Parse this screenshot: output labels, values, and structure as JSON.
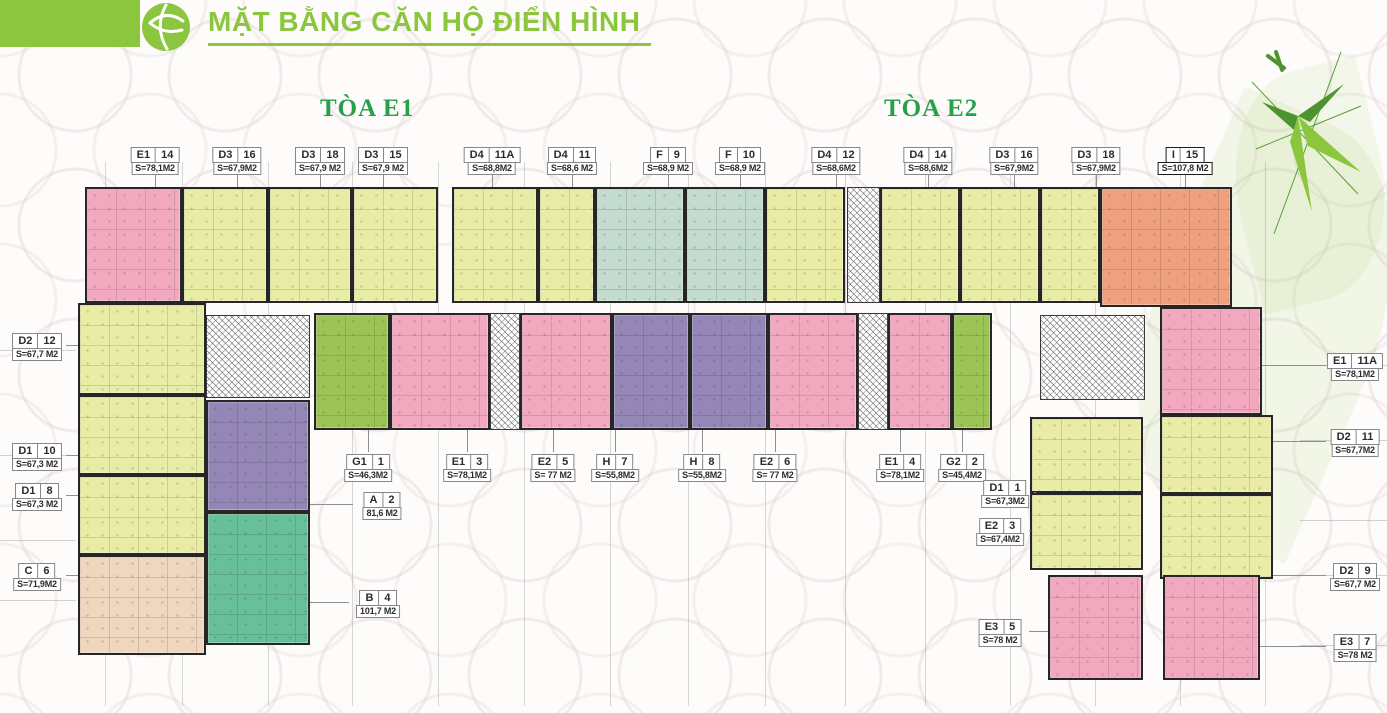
{
  "header": {
    "title": "MẶT BẰNG CĂN HỘ ĐIỂN HÌNH"
  },
  "towers": [
    {
      "label": "TÒA E1"
    },
    {
      "label": "TÒA E2"
    }
  ],
  "palette": {
    "accent_green": "#8CC63F",
    "tower_green": "#27A04A",
    "wall": "#262626",
    "pink": "#F2A9BF",
    "yellow": "#E9ECA4",
    "teal": "#C3DCCF",
    "purple": "#9486B6",
    "green": "#9CC455",
    "jade": "#68C09A",
    "peach": "#EFD6BD",
    "orange": "#EFA07E"
  },
  "plan": {
    "units": [
      {
        "code": "E1",
        "no": "14",
        "area": "S=78,1M2",
        "color": "pink",
        "block": [
          85,
          187,
          97,
          116
        ],
        "label": [
          155,
          145
        ],
        "leader": "down"
      },
      {
        "code": "D3",
        "no": "16",
        "area": "S=67,9M2",
        "color": "yellow",
        "block": [
          182,
          187,
          86,
          116
        ],
        "label": [
          237,
          145
        ],
        "leader": "down"
      },
      {
        "code": "D3",
        "no": "18",
        "area": "S=67,9 M2",
        "color": "yellow",
        "block": [
          268,
          187,
          84,
          116
        ],
        "label": [
          320,
          145
        ],
        "leader": "down"
      },
      {
        "code": "D3",
        "no": "15",
        "area": "S=67,9 M2",
        "color": "yellow",
        "block": [
          352,
          187,
          86,
          116
        ],
        "label": [
          383,
          145
        ],
        "leader": "down"
      },
      {
        "code": "D4",
        "no": "11A",
        "area": "S=68,8M2",
        "color": "yellow",
        "block": [
          452,
          187,
          86,
          116
        ],
        "label": [
          492,
          145
        ],
        "leader": "down"
      },
      {
        "code": "D4",
        "no": "11",
        "area": "S=68,6 M2",
        "color": "yellow",
        "block": [
          538,
          187,
          57,
          116
        ],
        "label": [
          572,
          145
        ],
        "leader": "down"
      },
      {
        "code": "F",
        "no": "9",
        "area": "S=68,9 M2",
        "color": "teal",
        "block": [
          595,
          187,
          90,
          116
        ],
        "label": [
          668,
          145
        ],
        "leader": "down"
      },
      {
        "code": "F",
        "no": "10",
        "area": "S=68,9 M2",
        "color": "teal",
        "block": [
          685,
          187,
          80,
          116
        ],
        "label": [
          740,
          145
        ],
        "leader": "down"
      },
      {
        "code": "D4",
        "no": "12",
        "area": "S=68,6M2",
        "color": "yellow",
        "block": [
          765,
          187,
          80,
          116
        ],
        "label": [
          836,
          145
        ],
        "leader": "down"
      },
      {
        "code": "D4",
        "no": "14",
        "area": "S=68,6M2",
        "color": "yellow",
        "block": [
          880,
          187,
          80,
          116
        ],
        "label": [
          928,
          145
        ],
        "leader": "down"
      },
      {
        "code": "D3",
        "no": "16",
        "area": "S=67,9M2",
        "color": "yellow",
        "block": [
          960,
          187,
          80,
          116
        ],
        "label": [
          1014,
          145
        ],
        "leader": "down"
      },
      {
        "code": "D3",
        "no": "18",
        "area": "S=67,9M2",
        "color": "yellow",
        "block": [
          1040,
          187,
          60,
          116
        ],
        "label": [
          1096,
          145
        ],
        "leader": "down"
      },
      {
        "code": "I",
        "no": "15",
        "area": "S=107,8 M2",
        "color": "orange",
        "block": [
          1100,
          187,
          132,
          120
        ],
        "label": [
          1185,
          145
        ],
        "leader": "down",
        "bold": true
      },
      {
        "code": "D2",
        "no": "12",
        "area": "S=67,7 M2",
        "color": "yellow",
        "block": [
          78,
          303,
          128,
          92
        ],
        "label": [
          37,
          331
        ],
        "leader": "right"
      },
      {
        "code": "D1",
        "no": "10",
        "area": "S=67,3 M2",
        "color": "yellow",
        "block": [
          78,
          395,
          128,
          80
        ],
        "label": [
          37,
          441
        ],
        "leader": "right"
      },
      {
        "code": "D1",
        "no": "8",
        "area": "S=67,3 M2",
        "color": "yellow",
        "block": [
          78,
          475,
          128,
          80
        ],
        "label": [
          37,
          481
        ],
        "leader": "right"
      },
      {
        "code": "C",
        "no": "6",
        "area": "S=71,9M2",
        "color": "peach",
        "block": [
          78,
          555,
          128,
          100
        ],
        "label": [
          37,
          561
        ],
        "leader": "right"
      },
      {
        "code": "A",
        "no": "2",
        "area": "81,6 M2",
        "color": "purple",
        "block": [
          206,
          400,
          104,
          112
        ],
        "label": [
          382,
          490
        ],
        "leader": "left"
      },
      {
        "code": "B",
        "no": "4",
        "area": "101,7 M2",
        "color": "jade",
        "block": [
          206,
          512,
          104,
          133
        ],
        "label": [
          378,
          588
        ],
        "leader": "left"
      },
      {
        "code": "G1",
        "no": "1",
        "area": "S=46,3M2",
        "color": "green",
        "block": [
          314,
          313,
          76,
          117
        ],
        "label": [
          368,
          452
        ],
        "leader": "up"
      },
      {
        "code": "E1",
        "no": "3",
        "area": "S=78,1M2",
        "color": "pink",
        "block": [
          390,
          313,
          100,
          117
        ],
        "label": [
          467,
          452
        ],
        "leader": "up"
      },
      {
        "code": "E2",
        "no": "5",
        "area": "S= 77 M2",
        "color": "pink",
        "block": [
          520,
          313,
          92,
          117
        ],
        "label": [
          553,
          452
        ],
        "leader": "up"
      },
      {
        "code": "H",
        "no": "7",
        "area": "S=55,8M2",
        "color": "purple",
        "block": [
          612,
          313,
          78,
          117
        ],
        "label": [
          615,
          452
        ],
        "leader": "up"
      },
      {
        "code": "H",
        "no": "8",
        "area": "S=55,8M2",
        "color": "purple",
        "block": [
          690,
          313,
          78,
          117
        ],
        "label": [
          702,
          452
        ],
        "leader": "up"
      },
      {
        "code": "E2",
        "no": "6",
        "area": "S= 77 M2",
        "color": "pink",
        "block": [
          768,
          313,
          90,
          117
        ],
        "label": [
          775,
          452
        ],
        "leader": "up"
      },
      {
        "code": "E1",
        "no": "4",
        "area": "S=78,1M2",
        "color": "pink",
        "block": [
          888,
          313,
          64,
          117
        ],
        "label": [
          900,
          452
        ],
        "leader": "up"
      },
      {
        "code": "G2",
        "no": "2",
        "area": "S=45,4M2",
        "color": "green",
        "block": [
          952,
          313,
          40,
          117
        ],
        "label": [
          962,
          452
        ],
        "leader": "up"
      },
      {
        "code": "D1",
        "no": "1",
        "area": "S=67,3M2",
        "color": "yellow",
        "block": [
          1030,
          417,
          113,
          76
        ],
        "label": [
          1005,
          478
        ],
        "leader": "right"
      },
      {
        "code": "E2",
        "no": "3",
        "area": "S=67,4M2",
        "color": "yellow",
        "block": [
          1030,
          493,
          113,
          77
        ],
        "label": [
          1000,
          516
        ],
        "leader": "right"
      },
      {
        "code": "E3",
        "no": "5",
        "area": "S=78 M2",
        "color": "pink",
        "block": [
          1048,
          575,
          95,
          105
        ],
        "label": [
          1000,
          617
        ],
        "leader": "right"
      },
      {
        "code": "E1",
        "no": "11A",
        "area": "S=78,1M2",
        "color": "pink",
        "block": [
          1160,
          307,
          102,
          108
        ],
        "label": [
          1355,
          351
        ],
        "leader": "left"
      },
      {
        "code": "D2",
        "no": "11",
        "area": "S=67,7M2",
        "color": "yellow",
        "block": [
          1160,
          415,
          113,
          79
        ],
        "label": [
          1355,
          427
        ],
        "leader": "left"
      },
      {
        "code": "D2",
        "no": "9",
        "area": "S=67,7 M2",
        "color": "yellow",
        "block": [
          1160,
          494,
          113,
          85
        ],
        "label": [
          1355,
          561
        ],
        "leader": "left"
      },
      {
        "code": "E3",
        "no": "7",
        "area": "S=78 M2",
        "color": "pink",
        "block": [
          1163,
          575,
          97,
          105
        ],
        "label": [
          1355,
          632
        ],
        "leader": "left"
      }
    ],
    "cores": [
      {
        "name": "elevator-core-e1",
        "rect": [
          206,
          315,
          104,
          83
        ]
      },
      {
        "name": "corridor-hatch-left",
        "rect": [
          490,
          313,
          30,
          117
        ]
      },
      {
        "name": "corridor-hatch-right",
        "rect": [
          858,
          313,
          30,
          117
        ]
      },
      {
        "name": "elevator-core-e2",
        "rect": [
          1040,
          315,
          105,
          85
        ]
      },
      {
        "name": "tower-gap-hatch",
        "rect": [
          847,
          187,
          33,
          116
        ]
      }
    ],
    "extras": [
      {
        "name": "unit-c6-lower",
        "color": "pink",
        "rect": [
          78,
          598,
          128,
          57
        ]
      }
    ]
  }
}
